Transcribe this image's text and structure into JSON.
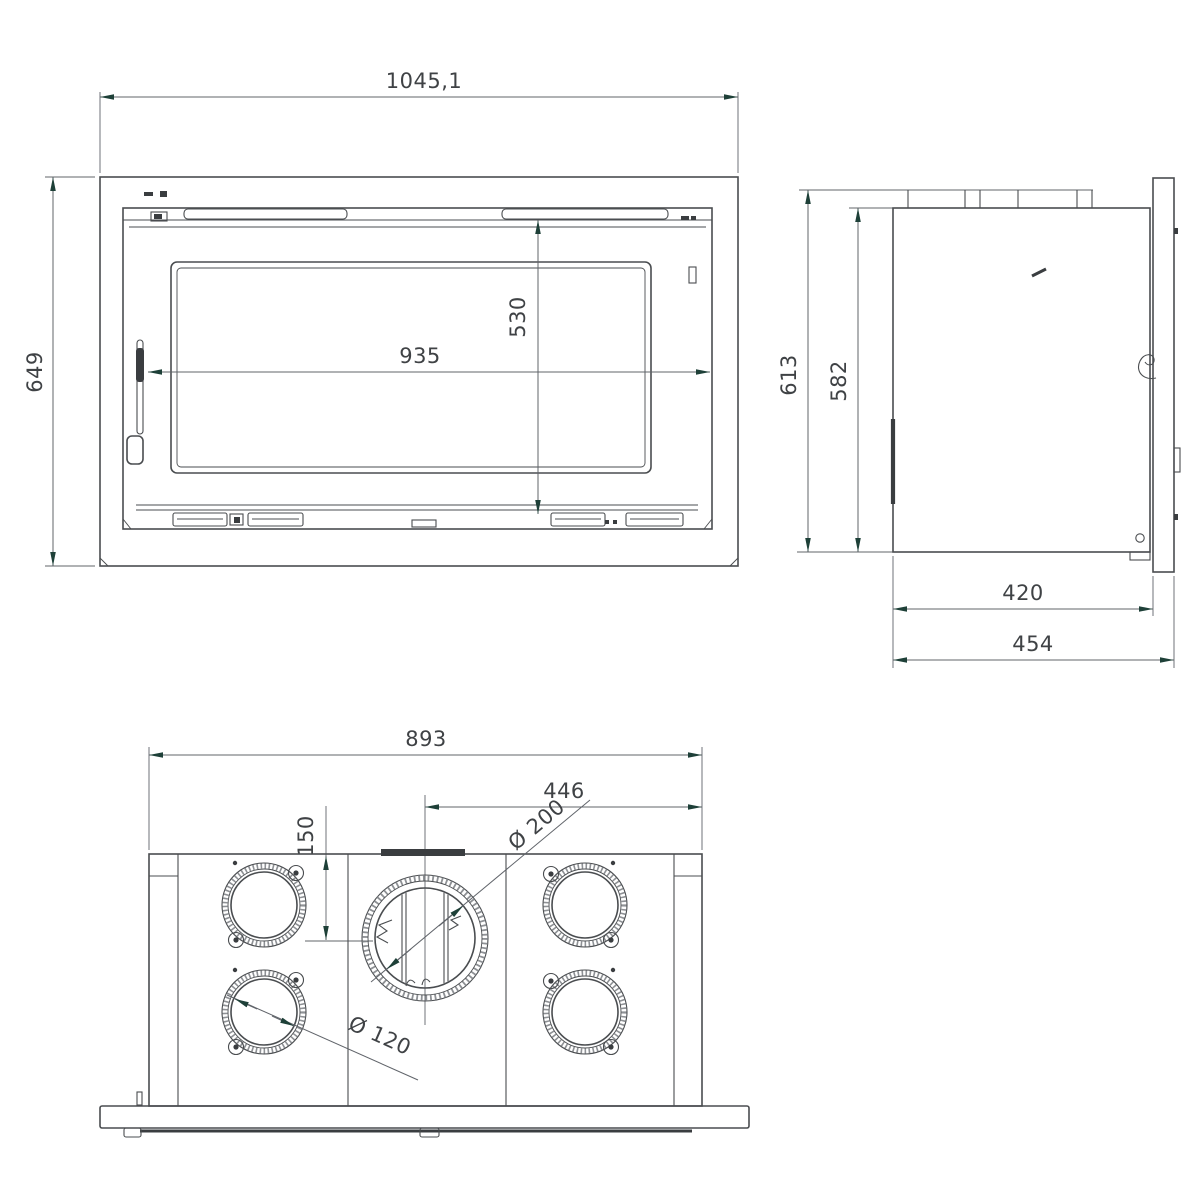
{
  "drawing": {
    "type": "technical-orthographic-drawing",
    "views": [
      "front-view",
      "side-view",
      "top-view"
    ],
    "dims": {
      "front_width": "1045,1",
      "front_height": "649",
      "door_width": "935",
      "door_height": "530",
      "side_height": "613",
      "side_inner_height": "582",
      "side_depth": "420",
      "side_total_depth": "454",
      "top_width": "893",
      "top_half_width": "446",
      "flue_offset": "150",
      "flue_diameter": "Ø 200",
      "spigot_diameter": "Ø 120"
    },
    "colors": {
      "line": "#4a4d50",
      "dim_line": "#60646a",
      "arrow": "#1e4038",
      "text": "#3f4245",
      "dark_fill": "#3a3d40",
      "background": "#ffffff"
    }
  }
}
